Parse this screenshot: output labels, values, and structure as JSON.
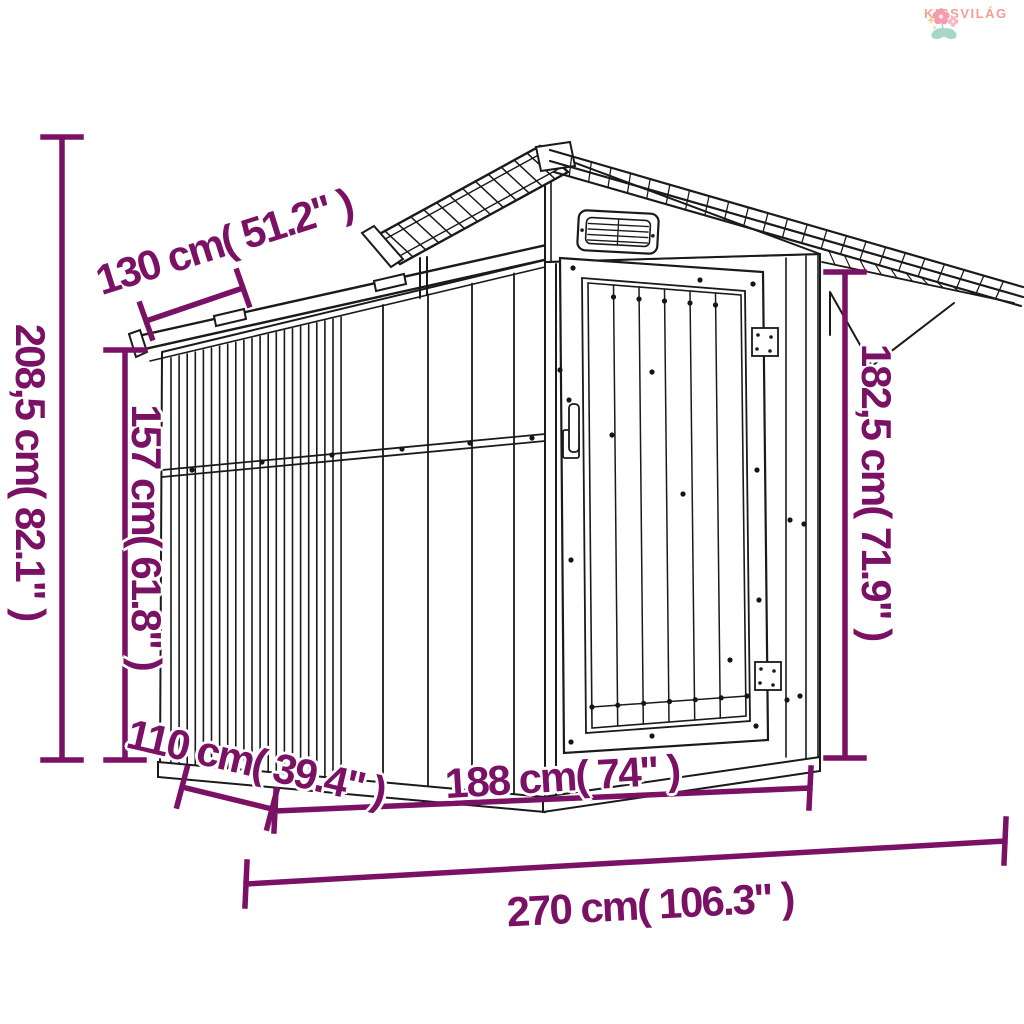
{
  "brand": {
    "name": "KISSVILÁG",
    "text_color": "#f0a095",
    "flower_pink": "#f29cac",
    "leaf_teal": "#a7d7cb",
    "star_yellow": "#f6d388"
  },
  "diagram": {
    "subject": "metal garden shed line drawing with dimension annotations",
    "line_color": "#1a1a1a",
    "dimension_color": "#7a1164",
    "dimensions": {
      "roof_overhang": {
        "label": "130 cm( 51.2\" )",
        "value_cm": "130",
        "value_in": "51.2"
      },
      "total_height": {
        "label": "208,5 cm( 82.1\" )",
        "value_cm": "208,5",
        "value_in": "82.1"
      },
      "wall_height": {
        "label": "157 cm( 61.8\" )",
        "value_cm": "157",
        "value_in": "61.8"
      },
      "right_height": {
        "label": "182,5 cm( 71.9\" )",
        "value_cm": "182,5",
        "value_in": "71.9"
      },
      "depth": {
        "label": "110 cm( 39.4\" )",
        "value_cm": "110",
        "value_in": "39.4"
      },
      "front_width": {
        "label": "188 cm( 74\" )",
        "value_cm": "188",
        "value_in": "74"
      },
      "total_width": {
        "label": "270 cm( 106.3\" )",
        "value_cm": "270",
        "value_in": "106.3"
      }
    }
  }
}
